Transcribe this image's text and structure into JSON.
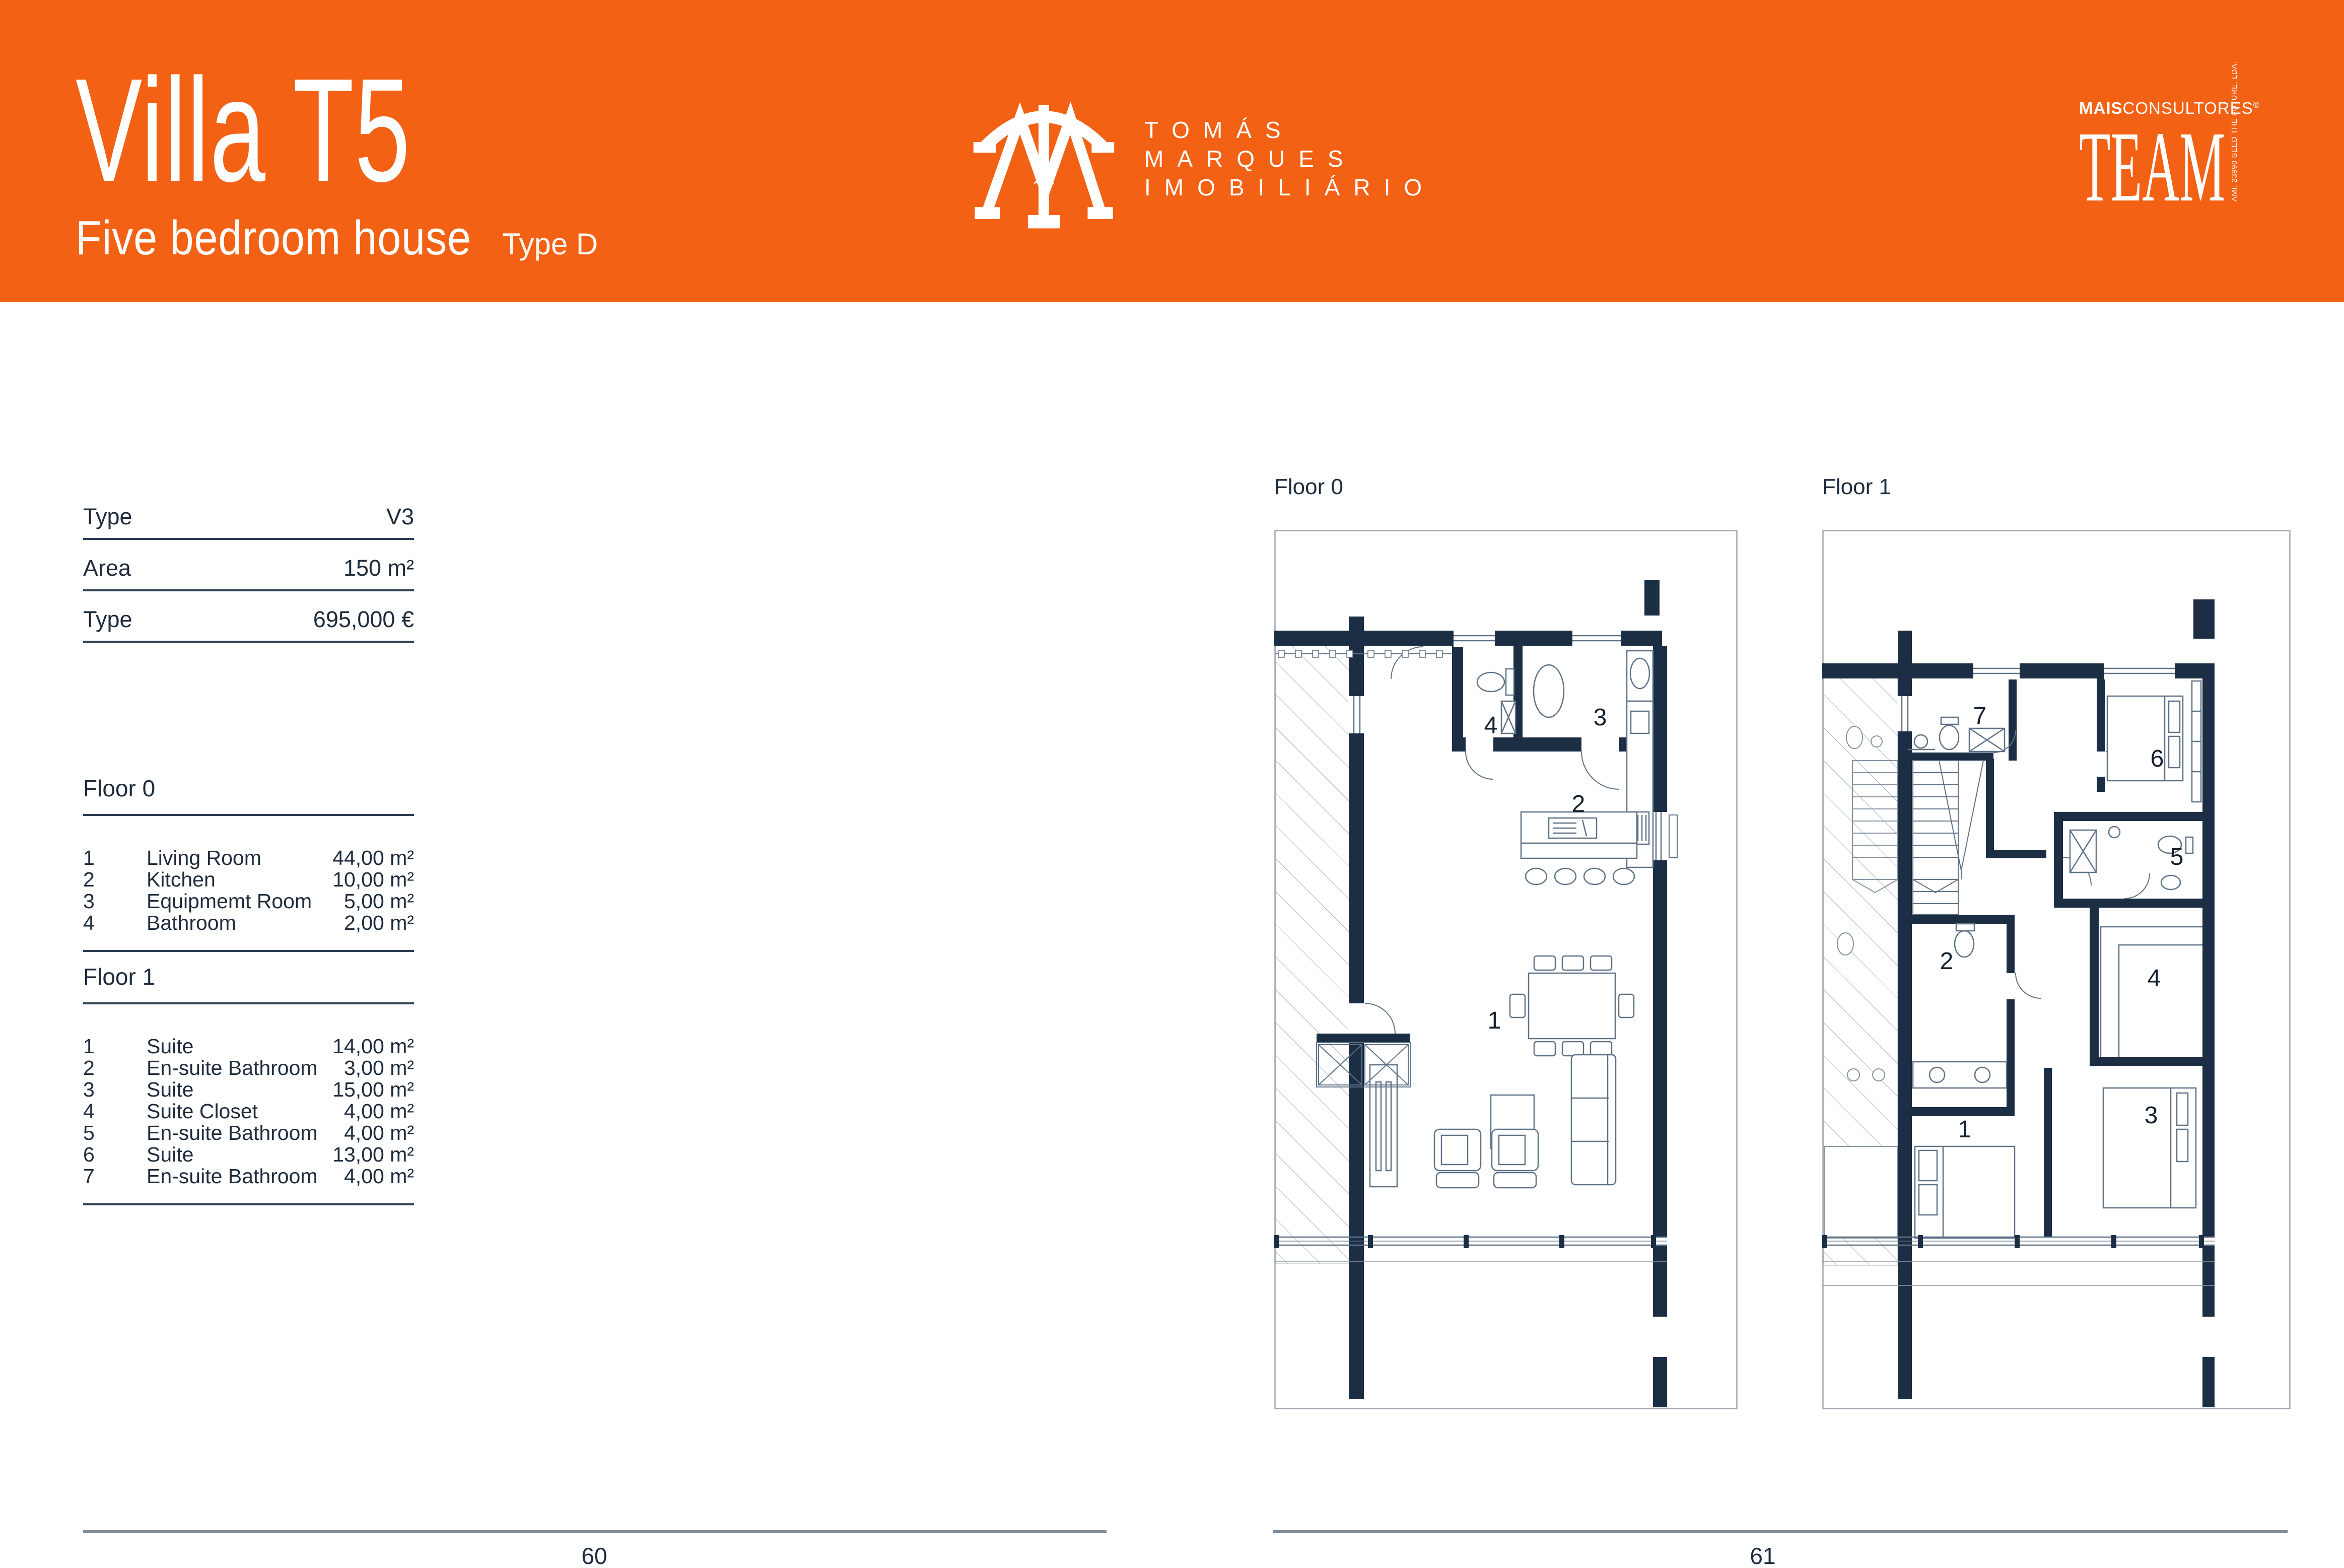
{
  "header": {
    "band_color": "#F26114",
    "title": "Villa T5",
    "subtitle": "Five bedroom house",
    "subtitle_tag": "Type D",
    "brand": {
      "line1": "TOMÁS",
      "line2": "MARQUES",
      "line3": "IMOBILIÁRIO"
    },
    "partner": {
      "brand_bold": "MAIS",
      "brand_rest": "CONSULTORES",
      "reg": "®",
      "wordmark": "TEAM",
      "side_text": "AMI: 23990  SEED THE FUTURE, LDA."
    }
  },
  "specs": {
    "rows": [
      {
        "label": "Type",
        "value": "V3"
      },
      {
        "label": "Area",
        "value": "150 m²"
      },
      {
        "label": "Type",
        "value": "695,000 €"
      }
    ]
  },
  "sections": [
    {
      "title": "Floor 0",
      "rows": [
        {
          "num": "1",
          "name": "Living Room",
          "area": "44,00 m²"
        },
        {
          "num": "2",
          "name": "Kitchen",
          "area": "10,00 m²"
        },
        {
          "num": "3",
          "name": "Equipmemt Room",
          "area": "5,00 m²"
        },
        {
          "num": "4",
          "name": "Bathroom",
          "area": "2,00 m²"
        }
      ]
    },
    {
      "title": "Floor 1",
      "rows": [
        {
          "num": "1",
          "name": "Suite",
          "area": "14,00 m²"
        },
        {
          "num": "2",
          "name": "En-suite Bathroom",
          "area": "3,00 m²"
        },
        {
          "num": "3",
          "name": "Suite",
          "area": "15,00 m²"
        },
        {
          "num": "4",
          "name": "Suite Closet",
          "area": "4,00 m²"
        },
        {
          "num": "5",
          "name": "En-suite Bathroom",
          "area": "4,00 m²"
        },
        {
          "num": "6",
          "name": "Suite",
          "area": "13,00 m²"
        },
        {
          "num": "7",
          "name": "En-suite Bathroom",
          "area": "4,00 m²"
        }
      ]
    }
  ],
  "plans": {
    "floor0": {
      "label": "Floor 0",
      "room_labels": [
        "1",
        "2",
        "3",
        "4"
      ]
    },
    "floor1": {
      "label": "Floor 1",
      "room_labels": [
        "1",
        "2",
        "3",
        "4",
        "5",
        "6",
        "7"
      ]
    }
  },
  "footer": {
    "pages": [
      "60",
      "61"
    ]
  },
  "colors": {
    "accent": "#F26114",
    "ink": "#1E2B3C",
    "rule": "#2C4056",
    "wall": "#1C2E44",
    "plan_line": "#5E7186",
    "hatch": "#93A1AE",
    "plan_border": "#9FA9B4",
    "footer_rule": "#7D8C98"
  }
}
